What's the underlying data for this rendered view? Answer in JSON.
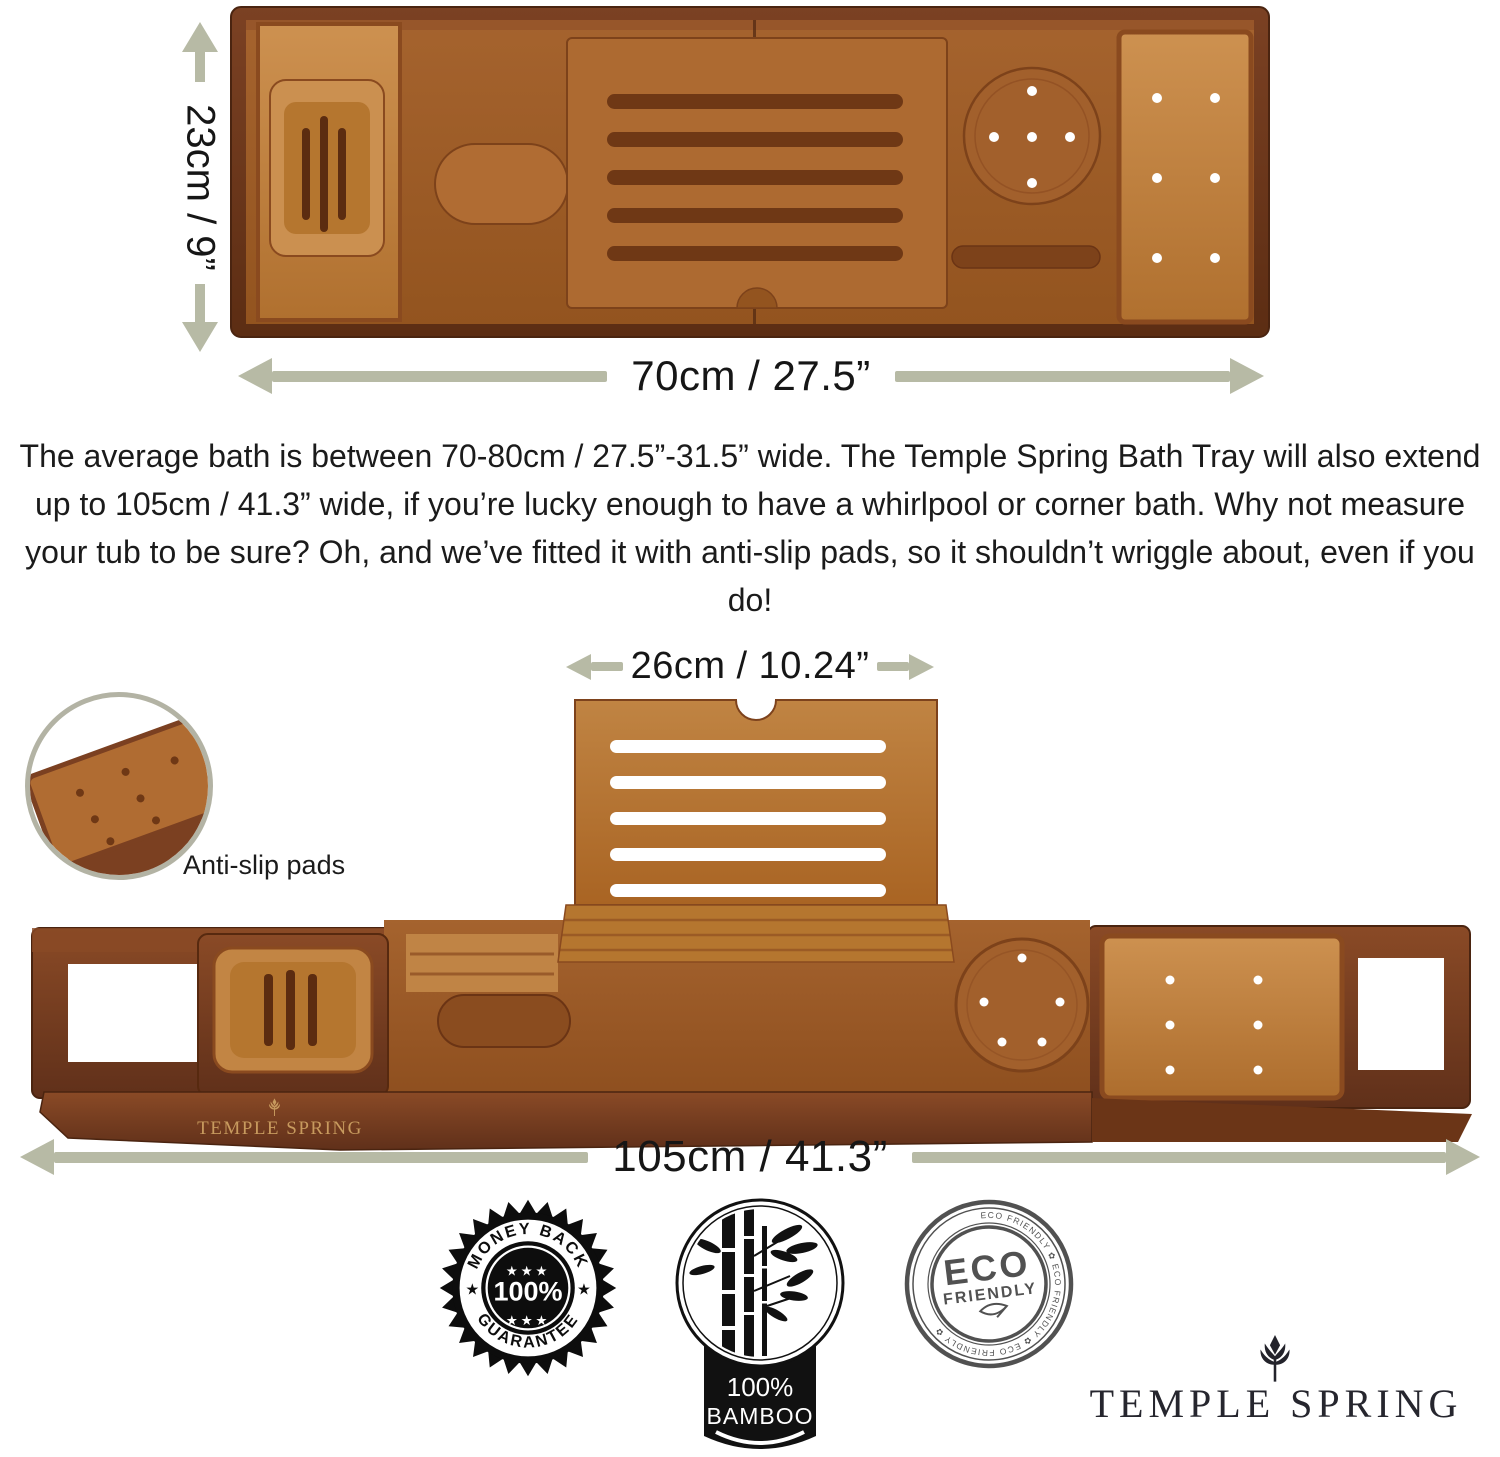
{
  "top_view": {
    "height_label": "23cm / 9”",
    "width_label": "70cm / 27.5”"
  },
  "description_paragraph": "The average bath is between 70-80cm / 27.5”-31.5” wide. The Temple Spring Bath Tray will also extend up to 105cm / 41.3” wide, if you’re lucky enough to have a whirlpool or corner bath. Why not measure your tub to be sure? Oh, and we’ve fitted it with anti-slip pads, so it shouldn’t wriggle about, even if you do!",
  "extended_view": {
    "stand_width_label": "26cm / 10.24”",
    "extended_width_label": "105cm / 41.3”",
    "anti_slip_label": "Anti-slip pads",
    "tray_engraving": "TEMPLE SPRING"
  },
  "badges": {
    "money_back": {
      "arc_top": "MONEY BACK",
      "center": "100%",
      "arc_bottom": "GUARANTEE",
      "stars_top": "★★★",
      "stars_bottom": "★★★",
      "star_left": "★",
      "star_right": "★"
    },
    "bamboo": {
      "percent": "100%",
      "material": "BAMBOO"
    },
    "eco": {
      "word1": "ECO",
      "word2": "FRIENDLY",
      "ring_text": "ECO FRIENDLY ✿ ECO FRIENDLY ✿ ECO FRIENDLY ✿"
    }
  },
  "brand_logo": "TEMPLE SPRING",
  "colors": {
    "dimension_arrow": "#b7baa5",
    "wood_dark": "#6e3a1e",
    "wood_mid": "#9c5c2a",
    "wood_honey": "#c08445",
    "engraving_gold": "#c79a5e",
    "text": "#1c1c1c"
  }
}
